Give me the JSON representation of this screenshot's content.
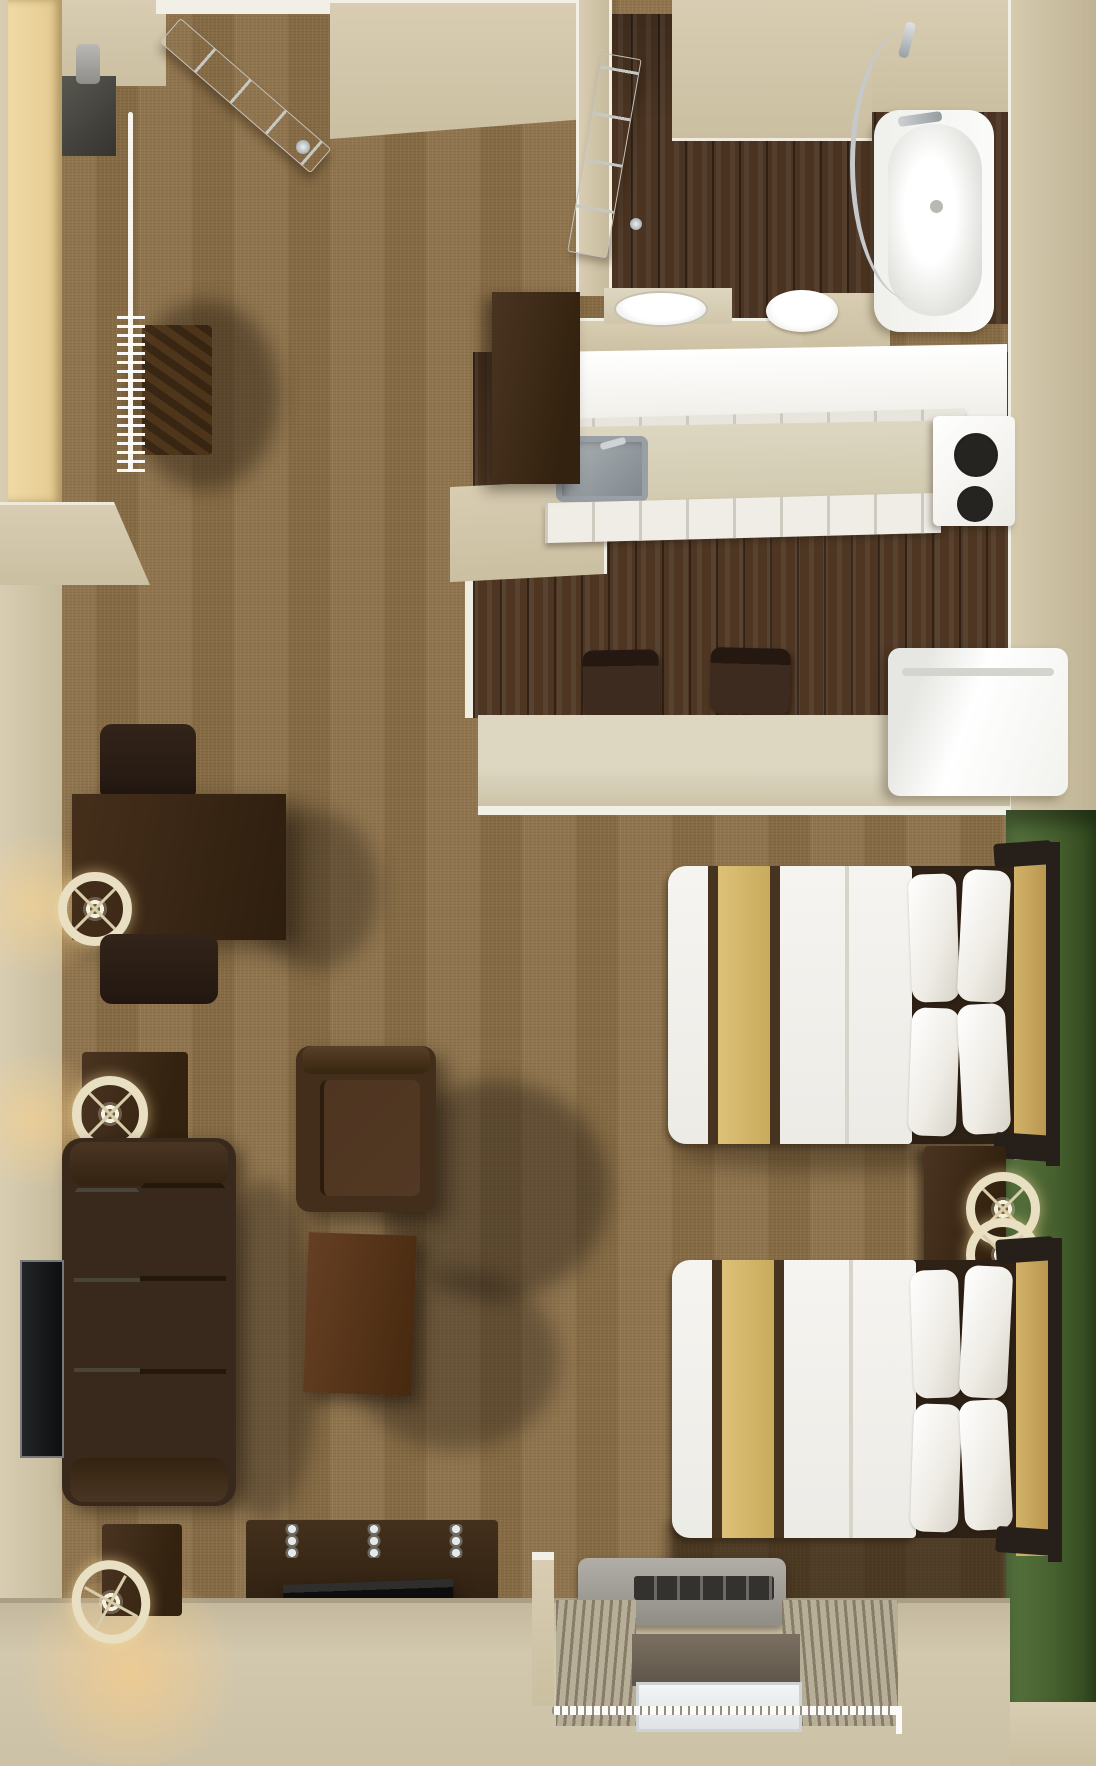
{
  "image": {
    "description": "Top-down 3D rendered floor plan of a studio suite with two double beds, kitchenette, bathroom and living area",
    "width_px": 1096,
    "height_px": 1766
  },
  "palette": {
    "carpet": "#8d7148",
    "wood_floor": "#4e3623",
    "wall_beige": "#d3c8ac",
    "accent_wall_green": "#4d6a37",
    "baseboard_white": "#f2efe4",
    "closet_wood": "#ecd49b",
    "dark_furniture": "#3b2a1b",
    "bed_runner_tan": "#d6b96d",
    "bed_trim_brown": "#463320",
    "linen_white": "#f3f1ec",
    "headboard_tan": "#c7a65c",
    "sofa_cushion_gray": "#8b8577",
    "stainless_steel": "#9aa0a4",
    "stove_burner_black": "#1b1916",
    "lamp_shade_cream": "#e9dfc3",
    "curtain_taupe": "#b7ae97",
    "window_glass": "#eef1f2",
    "ac_unit_gray": "#a3a19a",
    "tv_black": "#141414"
  },
  "rooms": {
    "entry": {
      "label": "Entry with open door and closet"
    },
    "bathroom": {
      "label": "Bathroom with bathtub, toilet and vanity sink"
    },
    "kitchen": {
      "label": "Kitchenette with sink, stove, refrigerator and bar counter"
    },
    "sleeping": {
      "label": "Sleeping area with two double beds against green accent wall"
    },
    "living": {
      "label": "Living area with sofa, armchair, desk and TVs"
    },
    "window_bay": {
      "label": "Window bay with curtains and air-conditioning unit"
    }
  },
  "furniture": {
    "entry_door": "entry door (open)",
    "closet_rod": "closet rod with hangers",
    "closet_shelf": "closet shelf unit",
    "bathtub": "bathtub",
    "shower_rod": "curved shower rod",
    "toilet": "toilet",
    "vanity_sink": "vanity sink",
    "bathroom_door": "bathroom door (open)",
    "kitchen_sink": "kitchen sink",
    "stove": "two-burner stove",
    "refrigerator": "refrigerator",
    "bar_counter": "bar counter",
    "bar_stool": "bar stool",
    "bed": "double bed with white linens and tan runner",
    "nightstand": "nightstand",
    "bedside_lamp": "bedside lamp",
    "desk": "work desk",
    "desk_chair": "desk chair",
    "desk_lamp": "desk lamp",
    "sofa": "sofa",
    "wall_tv": "wall-mounted TV",
    "armchair": "armchair",
    "side_table": "side table",
    "end_table": "end table",
    "table_lamp": "table lamp",
    "media_console": "media console with TV",
    "ac_unit": "air-conditioning unit",
    "window": "window with curtains"
  }
}
